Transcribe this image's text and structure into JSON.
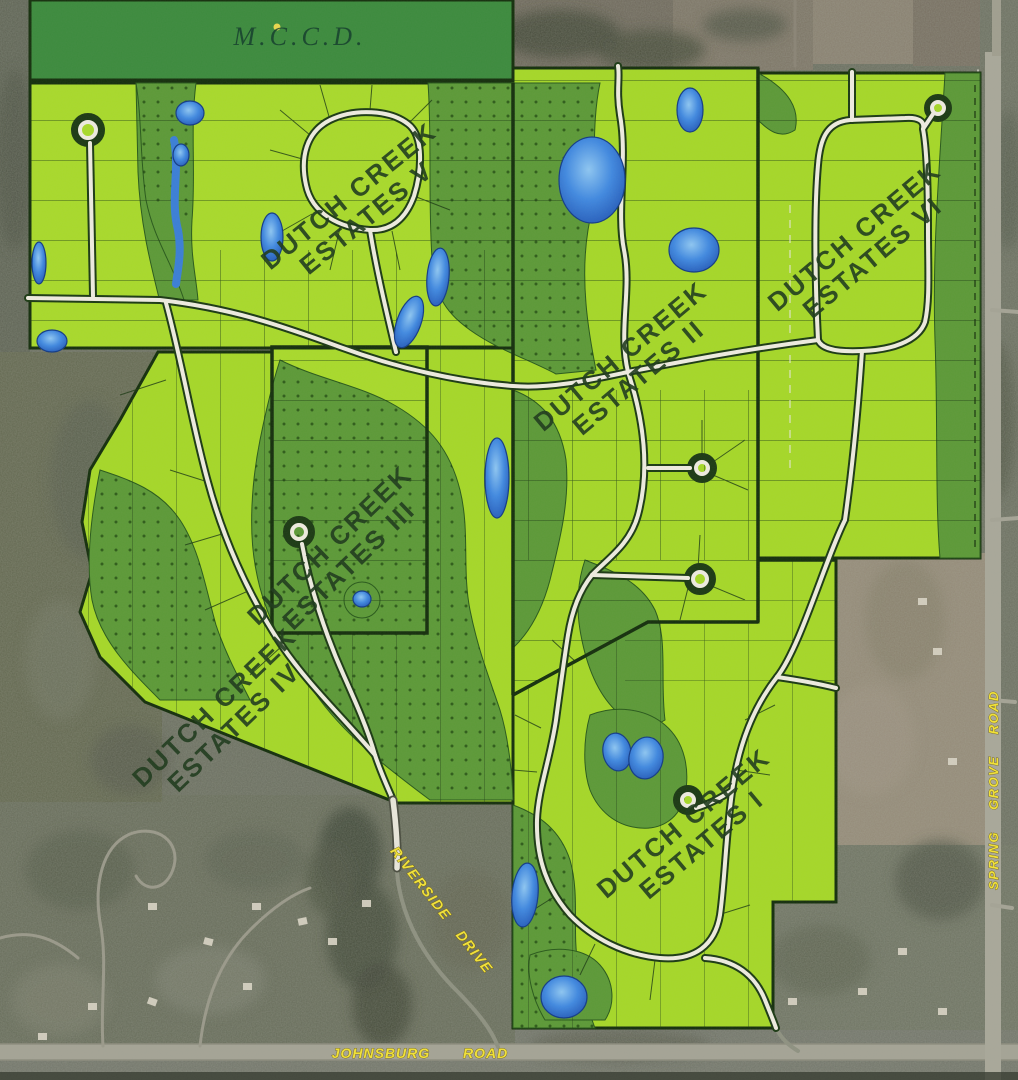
{
  "map": {
    "agency_label": "M.C.C.D.",
    "subdivisions": [
      {
        "id": "v",
        "name": "Dutch Creek Estates V",
        "line1": "DUTCH CREEK",
        "line2": "ESTATES V"
      },
      {
        "id": "ii",
        "name": "Dutch Creek Estates II",
        "line1": "DUTCH CREEK",
        "line2": "ESTATES II"
      },
      {
        "id": "vi",
        "name": "Dutch Creek Estates VI",
        "line1": "DUTCH CREEK",
        "line2": "ESTATES VI"
      },
      {
        "id": "iii",
        "name": "Dutch Creek Estates III",
        "line1": "DUTCH CREEK",
        "line2": "ESTATES III"
      },
      {
        "id": "iv",
        "name": "Dutch Creek Estates IV",
        "line1": "DUTCH CREEK",
        "line2": "ESTATES IV"
      },
      {
        "id": "i",
        "name": "Dutch Creek Estates I",
        "line1": "DUTCH CREEK",
        "line2": "ESTATES I"
      }
    ],
    "road_labels": {
      "riverside": "RIVERSIDE DRIVE",
      "johnsburg": "JOHNSBURG ROAD",
      "spring_grove": "SPRING GROVE ROAD"
    },
    "colors": {
      "lot_green": "#a6d829",
      "woodland_green": "#5d9a38",
      "mccd_green": "#3d8b3e",
      "pond_blue": "#4189e0",
      "road_fill": "#eeebdf",
      "boundary_dark": "#16300e",
      "road_label_yellow": "#f2e238",
      "aerial_olive": "#6b6f60"
    }
  }
}
